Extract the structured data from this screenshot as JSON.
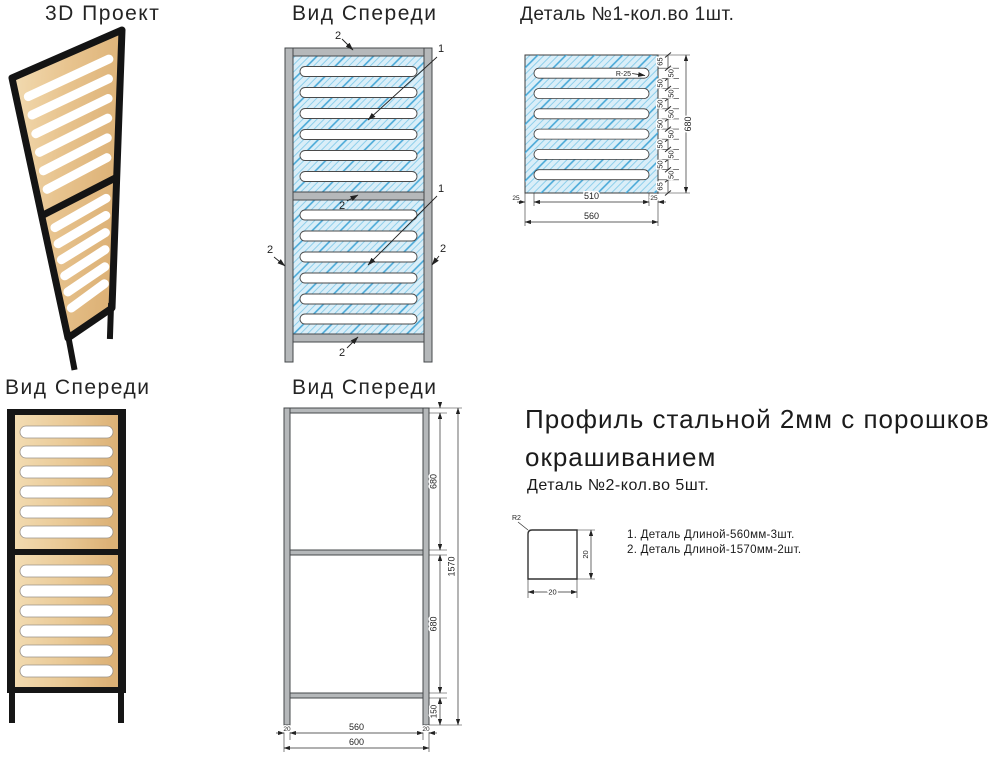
{
  "titles": {
    "view3d": "3D Проект",
    "front_top": "Вид Спереди",
    "detail1": "Деталь №1-кол.во 1шт.",
    "front_bottom_left": "Вид Спереди",
    "front_bottom_mid": "Вид Спереди"
  },
  "callouts": {
    "panel": "1",
    "profile": "2"
  },
  "detail1": {
    "radius_label": "R-25",
    "chain": [
      "65",
      "50",
      "50",
      "50",
      "50",
      "50",
      "50",
      "50",
      "50",
      "50",
      "50",
      "50",
      "65"
    ],
    "overall_height": "680",
    "bottom_segments": [
      "25",
      "510",
      "25"
    ],
    "bottom_overall": "560"
  },
  "frame_view": {
    "seg_top": "680",
    "seg_bottom": "680",
    "seg_legs": "150",
    "overall": "1570",
    "bottom_left": "20",
    "bottom_mid": "560",
    "bottom_right": "20",
    "bottom_overall": "600"
  },
  "spec": {
    "heading_line1": "Профиль стальной 2мм с порошковым",
    "heading_line2": "окрашиванием",
    "subtitle": "Деталь №2-кол.во 5шт.",
    "profile": {
      "radius": "R2",
      "width": "20",
      "height": "20"
    },
    "notes": [
      "1. Деталь Длиной-560мм-3шт.",
      "2. Деталь Длиной-1570мм-2шт."
    ]
  },
  "colors": {
    "hatch_bg": "#daeef8",
    "hatch_line": "#8ecfeb",
    "hatch_accent": "#45a6d6",
    "frame_gray": "#b5b8ba",
    "frame_stroke": "#45484b",
    "wood_light": "#f3ddb4",
    "wood_dark": "#ddb277",
    "frame_black": "#151515",
    "dim_line": "#2c2c2c"
  }
}
